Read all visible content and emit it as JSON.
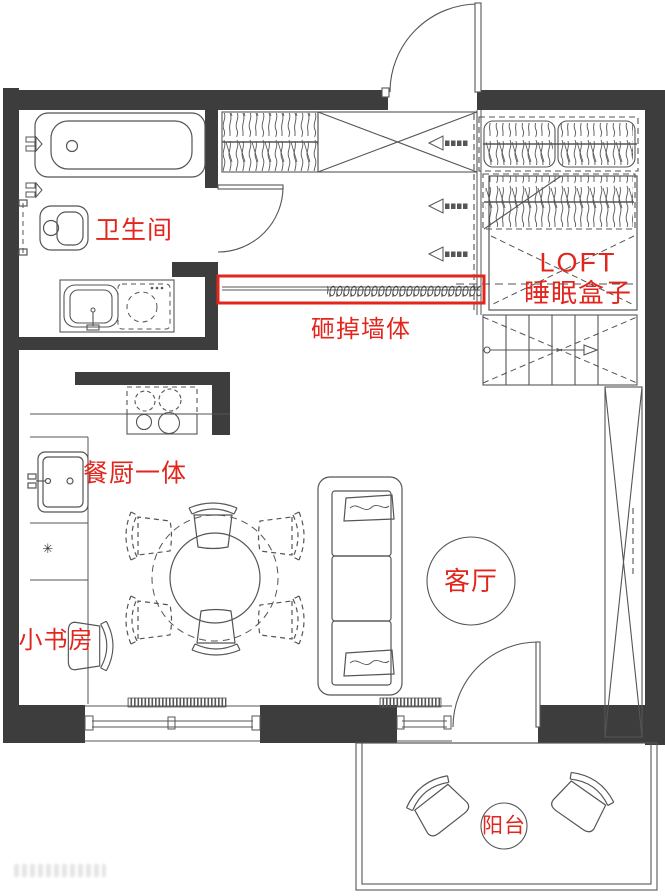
{
  "page": {
    "type": "residential floor plan",
    "width": 665,
    "height": 896
  },
  "colors": {
    "wall": "#3d3d3d",
    "line": "#555555",
    "annotation": "#e2261d",
    "background": "#ffffff"
  },
  "annotations": {
    "bathroom": "卫生间",
    "demolish_wall": "砸掉墙体",
    "loft_line1": "LOFT",
    "loft_line2": "睡眠盒子",
    "kitchen_dining": "餐厨一体",
    "study": "小书房",
    "living_room": "客厅",
    "balcony": "阳台"
  },
  "symbols": {
    "kitchen_marker": "✳"
  },
  "fixtures": [
    "entry-door",
    "hanging-wardrobe",
    "shoe-cabinet-x",
    "loft-wardrobes",
    "loft-sleep-box",
    "stairs",
    "direction-arrows",
    "bathtub",
    "toilet",
    "vanity-basin",
    "washing-machine",
    "demolished-wall-scribble",
    "cooktop",
    "kitchen-sink",
    "kitchen-counter",
    "dining-table",
    "dining-chairs",
    "desk-chair",
    "sofa",
    "area-rug",
    "tall-cabinet-x",
    "windows",
    "radiators",
    "balcony-armchairs",
    "balcony-rail"
  ]
}
